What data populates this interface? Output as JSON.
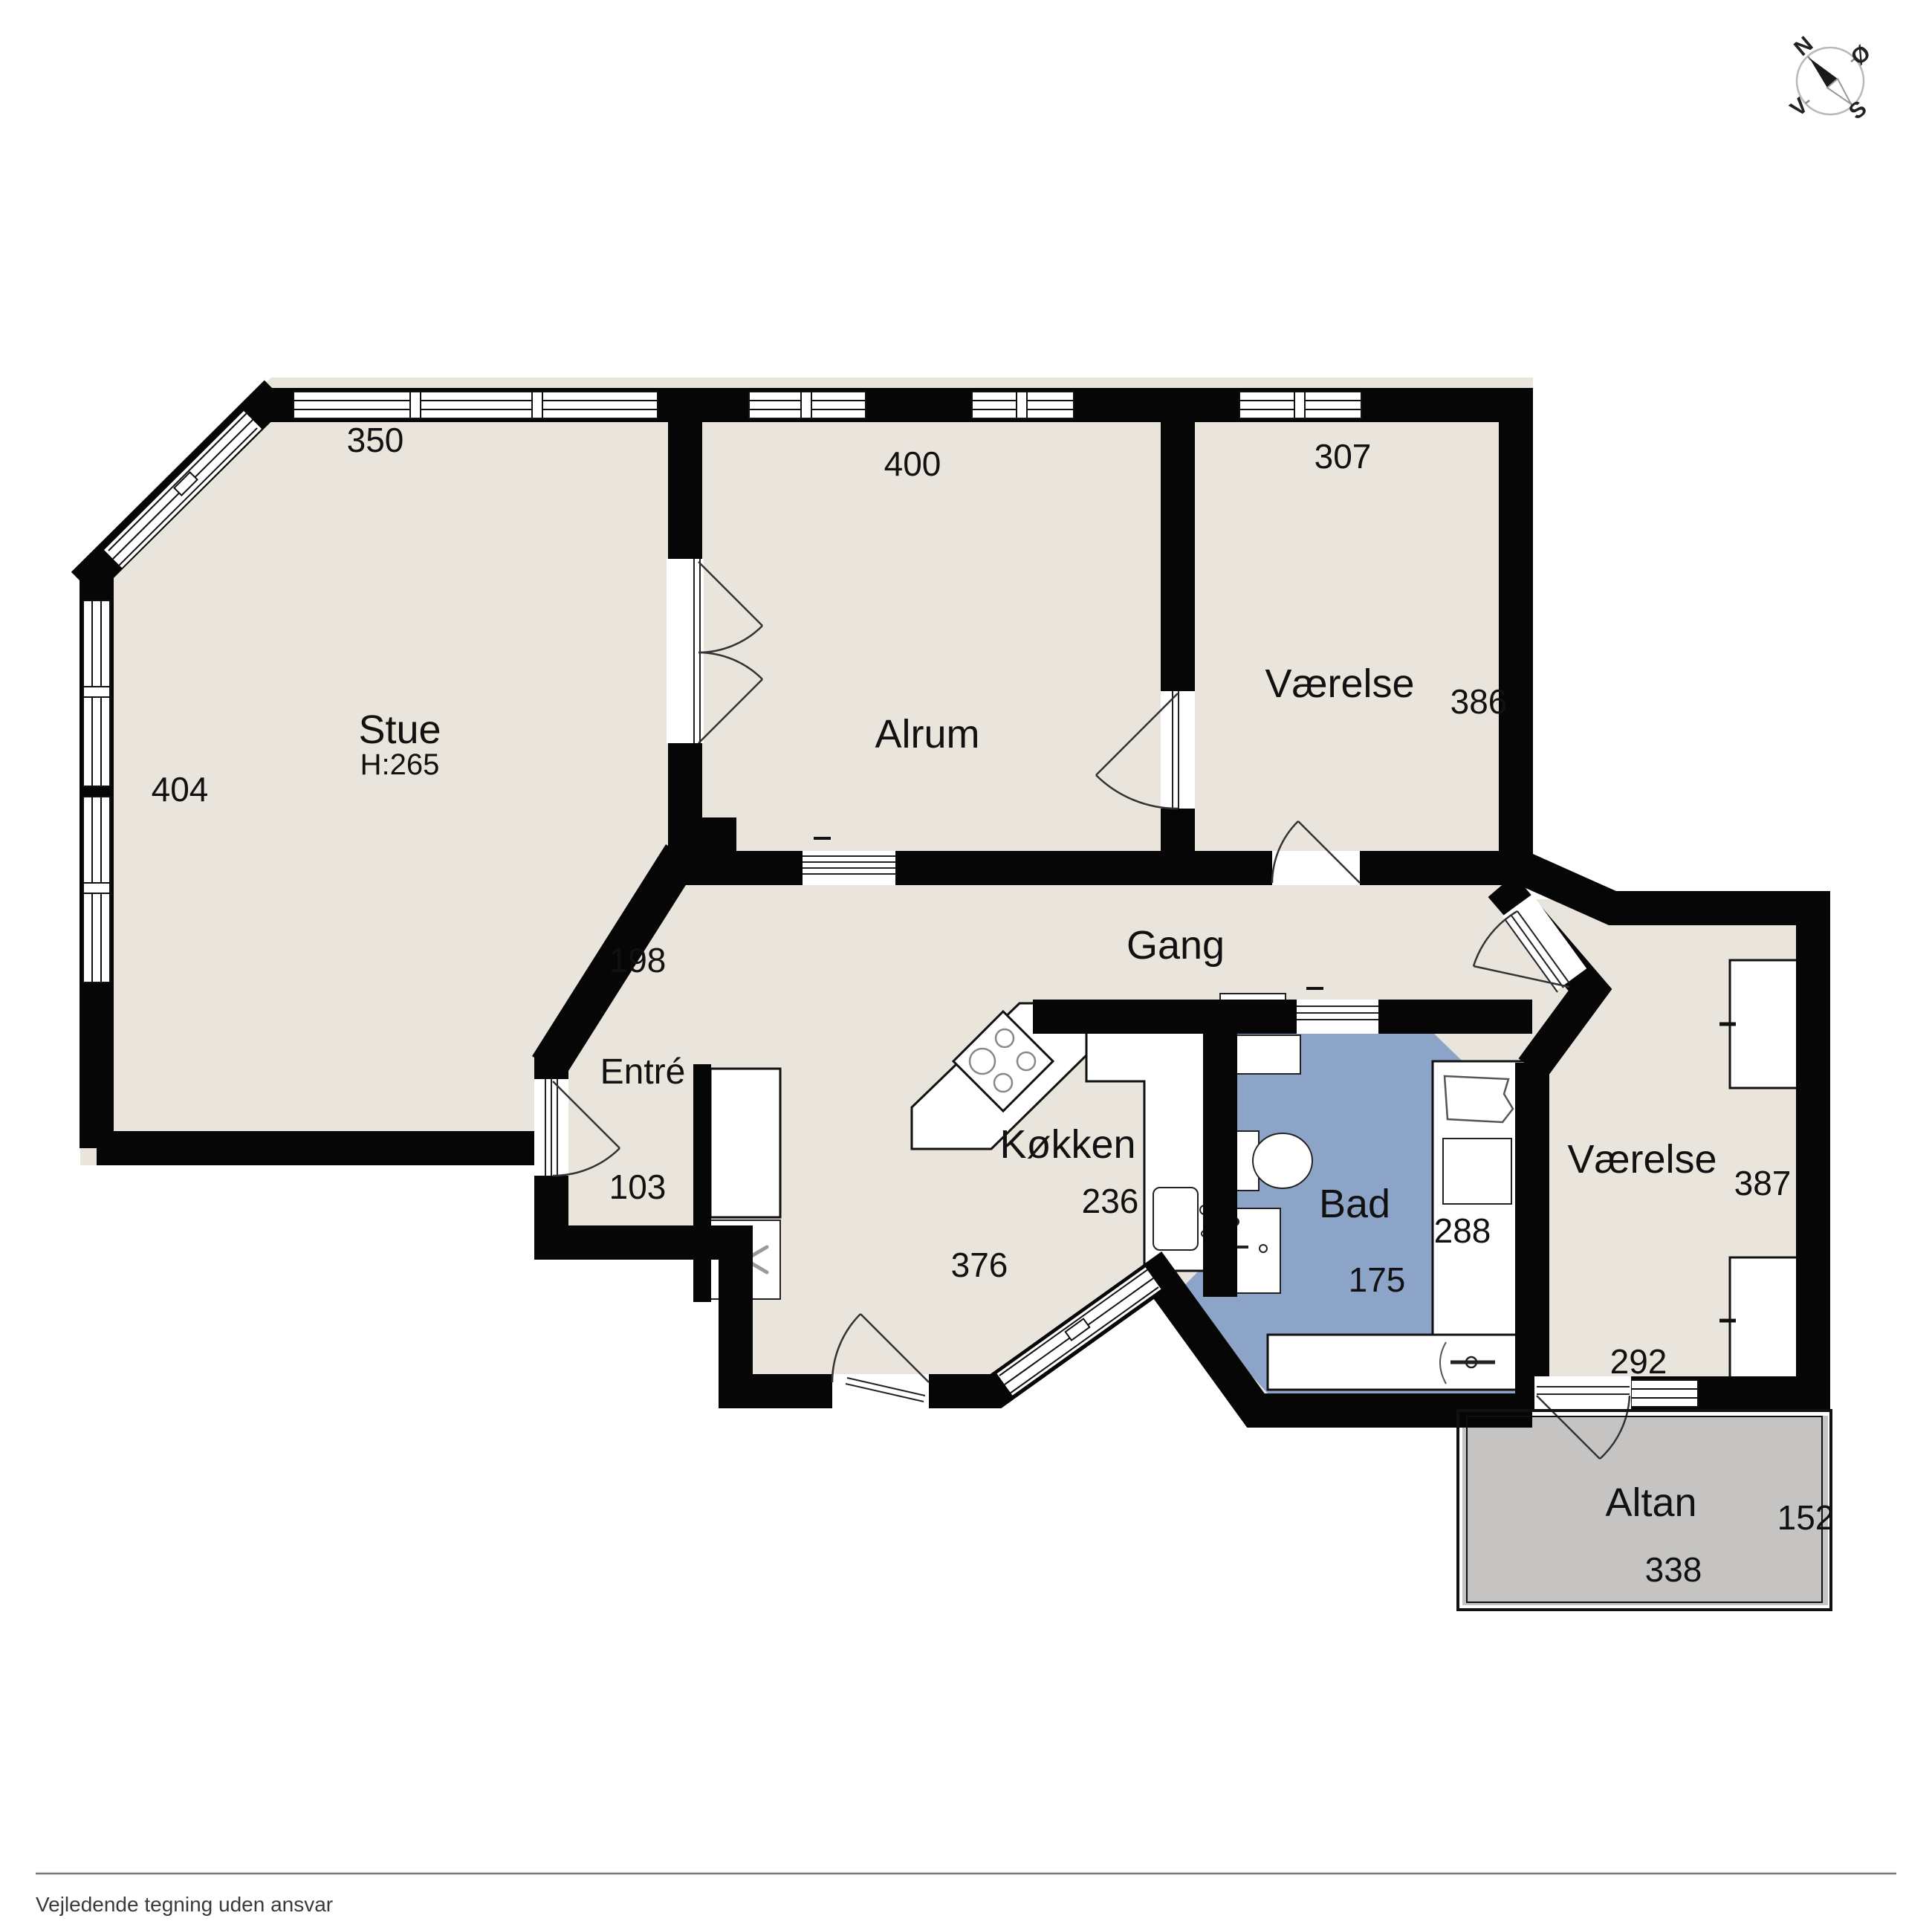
{
  "rooms": {
    "stue": {
      "label": "Stue",
      "height_note": "H:265"
    },
    "alrum": {
      "label": "Alrum"
    },
    "vaerelse_top": {
      "label": "Værelse"
    },
    "gang": {
      "label": "Gang"
    },
    "entre": {
      "label": "Entré"
    },
    "koekken": {
      "label": "Køkken"
    },
    "bad": {
      "label": "Bad"
    },
    "vaerelse_bottom": {
      "label": "Værelse"
    },
    "altan": {
      "label": "Altan"
    }
  },
  "measurements": {
    "stue_top": "350",
    "stue_left": "404",
    "alrum_top": "400",
    "vaerelse_top_width": "307",
    "vaerelse_top_depth": "386",
    "gang_diagonal": "198",
    "entre_width": "103",
    "koekken_width": "236",
    "koekken_depth": "376",
    "bad_width": "175",
    "bad_depth": "288",
    "vaerelse_bottom_depth": "387",
    "vaerelse_bottom_width": "292",
    "altan_depth": "152",
    "altan_width": "338"
  },
  "compass": {
    "north": "N",
    "east": "Ø",
    "south": "S",
    "west": "V"
  },
  "footer": {
    "disclaimer": "Vejledende tegning uden ansvar"
  },
  "colors": {
    "floor": "#E9E4DC",
    "bathroom_floor": "#8CA4C8",
    "balcony_floor": "#C5C4C2",
    "wall": "#060606",
    "background": "#FFFFFF"
  }
}
